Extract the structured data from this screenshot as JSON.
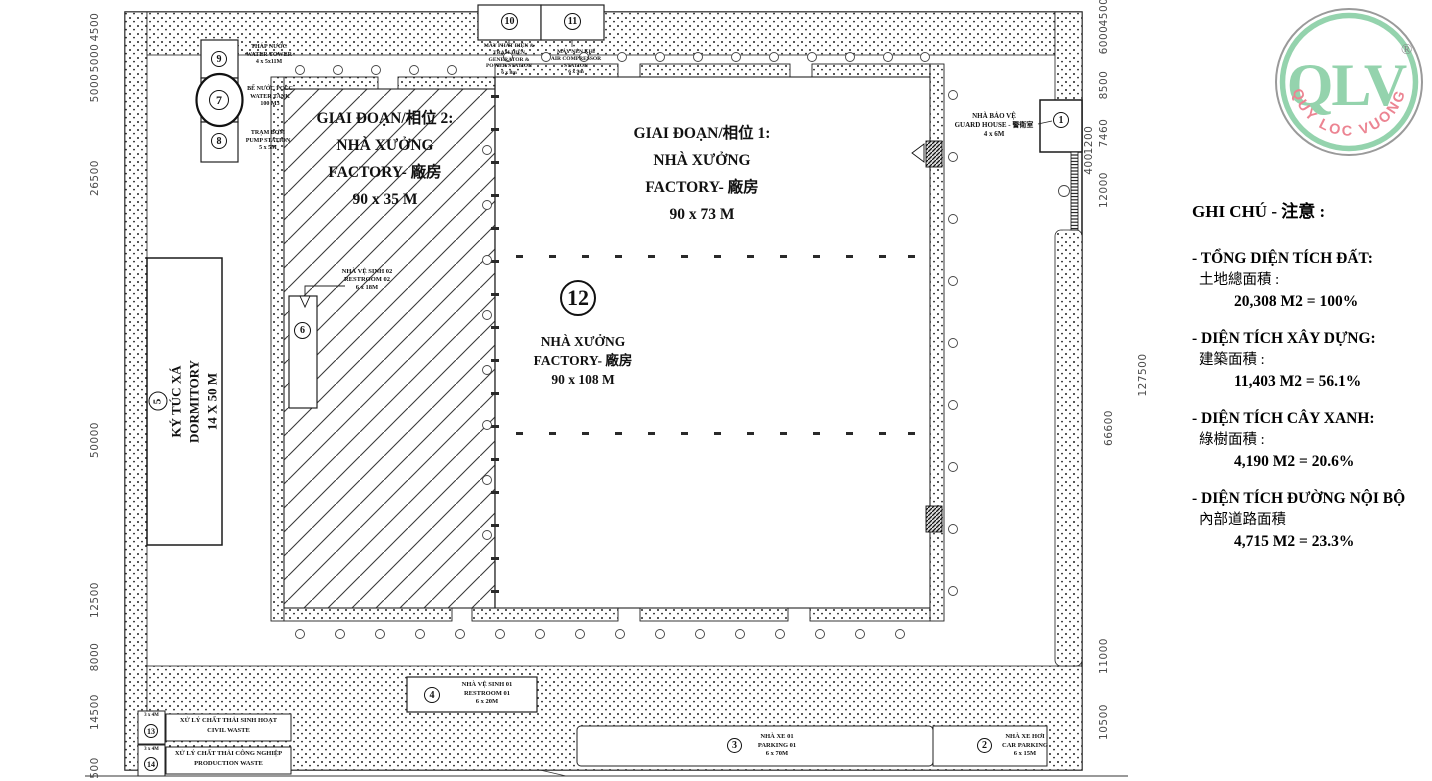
{
  "logo": {
    "text": "QLV",
    "reg": "®",
    "arc_text": "QUY LOC VUONG",
    "green": "#94d3ad",
    "red": "#ec8492",
    "ring_gray": "#9a9a9a"
  },
  "legend": {
    "title": "GHI CHÚ - 注意 :",
    "items": [
      {
        "vn": "- TỔNG DIỆN TÍCH ĐẤT:",
        "cn": "土地總面積 :",
        "value": "20,308 M2 = 100%"
      },
      {
        "vn": "- DIỆN TÍCH XÂY DỰNG:",
        "cn": "建築面積 :",
        "value": "11,403 M2 = 56.1%"
      },
      {
        "vn": "- DIỆN TÍCH CÂY XANH:",
        "cn": "綠樹面積 :",
        "value": "4,190 M2 = 20.6%"
      },
      {
        "vn": "- DIỆN TÍCH ĐƯỜNG NỘI BỘ",
        "cn": "內部道路面積",
        "value": "4,715 M2 = 23.3%"
      }
    ]
  },
  "factories": {
    "phase2": {
      "l1": "GIAI ĐOẠN/相位 2:",
      "l2": "NHÀ XƯỞNG",
      "l3": "FACTORY- 廠房",
      "l4": "90 x 35 M"
    },
    "phase1": {
      "l1": "GIAI ĐOẠN/相位 1:",
      "l2": "NHÀ XƯỞNG",
      "l3": "FACTORY- 廠房",
      "l4": "90 x 73 M"
    },
    "main": {
      "num": "12",
      "l1": "NHÀ XƯỞNG",
      "l2": "FACTORY- 廠房",
      "l3": "90 x 108 M"
    }
  },
  "facilities": {
    "dormitory": {
      "num": "5",
      "l1": "KÝ TÚC XÁ",
      "l2": "DORMITORY",
      "l3": "14 X 50 M"
    },
    "water_tower": {
      "num": "9",
      "l1": "THÁP NƯỚC",
      "l2": "WATER TOWER",
      "l3": "4 x 5x11M"
    },
    "water_tank": {
      "num": "7",
      "l1": "BỂ NƯỚC PCCC",
      "l2": "WATER TANK",
      "l3": "100 M3"
    },
    "pump_station": {
      "num": "8",
      "l1": "TRẠM BƠM",
      "l2": "PUMP STATION",
      "l3": "5 x 5M"
    },
    "generator": {
      "num": "10",
      "l1": "MÁY PHÁT ĐIỆN &",
      "l2": "TRẠM ĐIỆN",
      "l3": "GENERATOR &",
      "l4": "POWER STATION",
      "l5": "6 x 8m"
    },
    "compressor": {
      "num": "11",
      "l1": "MÁY NÉN KHÍ",
      "l2": "AIR COMPRESSOR STATION",
      "l3": "6 x 9m"
    },
    "guard_house": {
      "num": "1",
      "l1": "NHÀ BẢO VỆ",
      "l2": "GUARD HOUSE - 警衛室",
      "l3": "4 x 6M"
    },
    "restroom02": {
      "num": "6",
      "l1": "NHÀ VỆ SINH 02",
      "l2": "RESTROOM 02",
      "l3": "6 x 18M"
    },
    "restroom01": {
      "num": "4",
      "l1": "NHÀ VỆ SINH 01",
      "l2": "RESTROOM 01",
      "l3": "6 x 20M"
    },
    "parking01": {
      "num": "3",
      "l1": "NHÀ XE 01",
      "l2": "PARKING 01",
      "l3": "6 x 70M"
    },
    "car_parking": {
      "num": "2",
      "l1": "NHÀ XE HƠI",
      "l2": "CAR PARKING",
      "l3": "6 x 15M"
    },
    "civil_waste": {
      "num": "13",
      "size": "3 x 4M",
      "l1": "XỬ LÝ CHẤT THẢI SINH HOẠT",
      "l2": "CIVIL WASTE"
    },
    "production_waste": {
      "num": "14",
      "size": "3 x 4M",
      "l1": "XỬ LÝ CHẤT THẢI CÔNG NGHIỆP",
      "l2": "PRODUCTION WASTE"
    }
  },
  "dimensions": {
    "left": [
      "4500",
      "5000",
      "5000",
      "26500",
      "50000",
      "12500",
      "8000",
      "14500",
      "500"
    ],
    "right": [
      "4500",
      "6000",
      "8500",
      "7460",
      "1200",
      "400",
      "12000",
      "66600",
      "11000",
      "10500"
    ],
    "right_outer": "127500"
  }
}
